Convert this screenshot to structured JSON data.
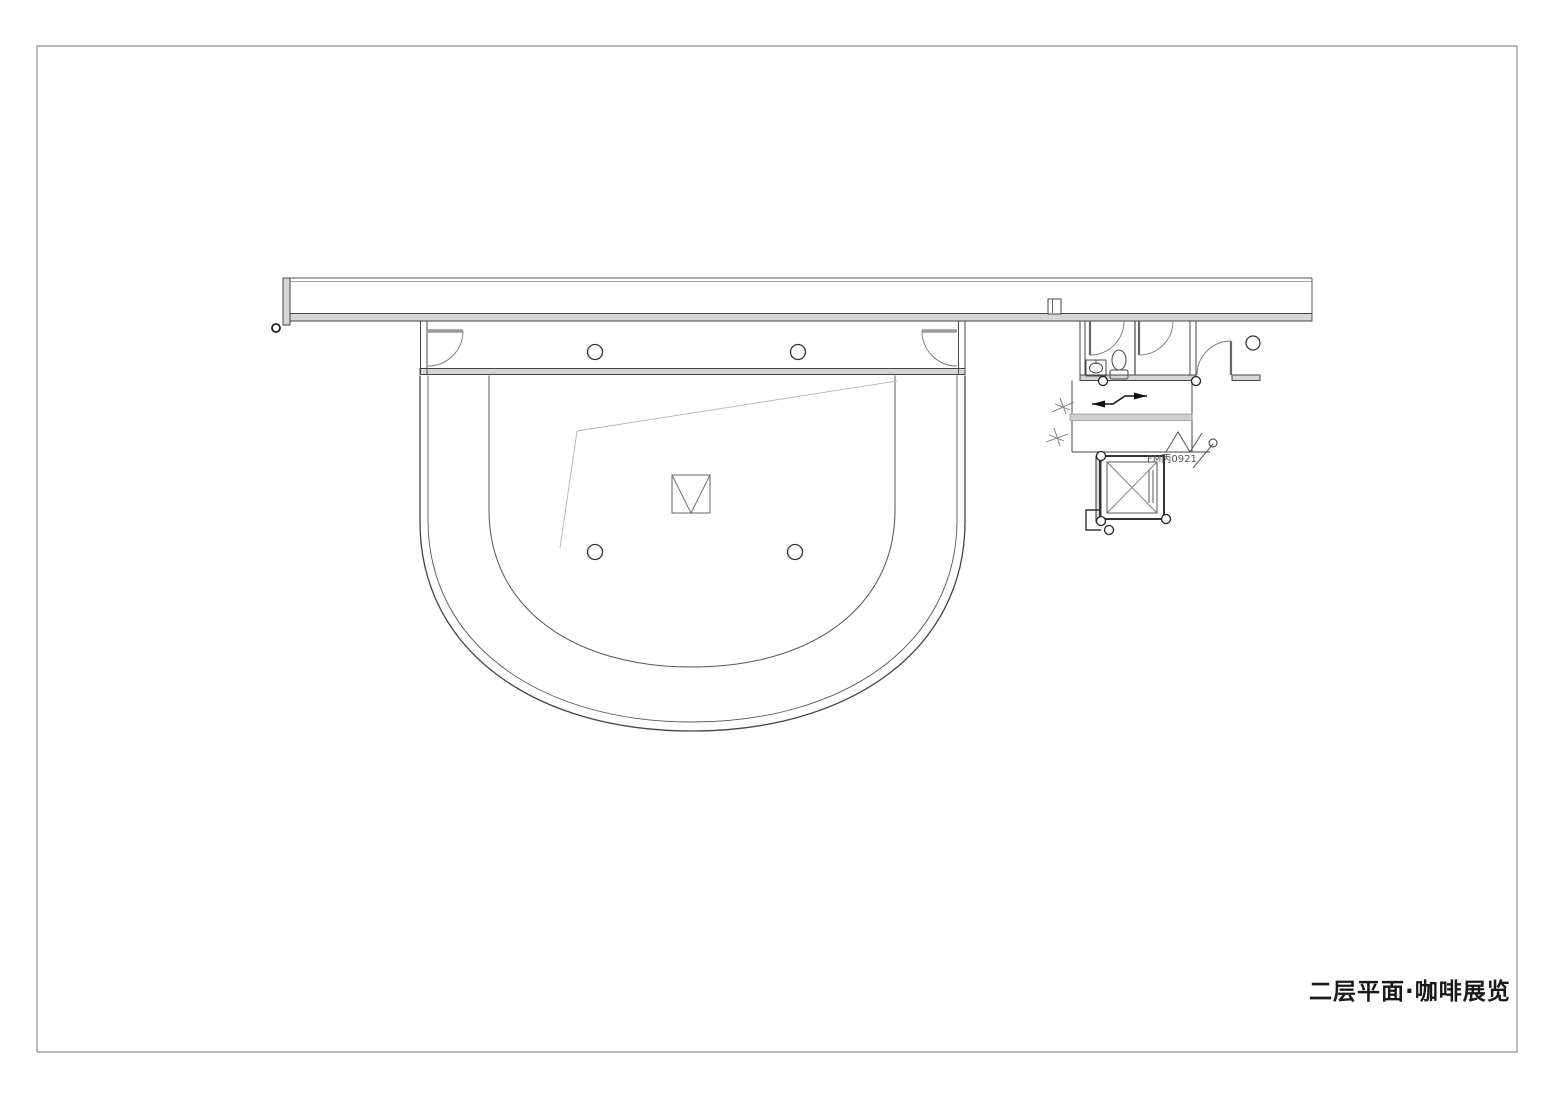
{
  "drawing": {
    "title": "二层平面·咖啡展览",
    "door_tag": "FM丙0921",
    "colors": {
      "paper": "#ffffff",
      "frame": "#9c9c9c",
      "ink": "#474747",
      "mid": "#5a5a5a",
      "light": "#999999",
      "faint": "#b3b3b3",
      "wall_fill": "#d6d6d6",
      "handrail_fill": "#cfcfcf",
      "black": "#111111",
      "title_color": "#1a1a1a"
    }
  }
}
